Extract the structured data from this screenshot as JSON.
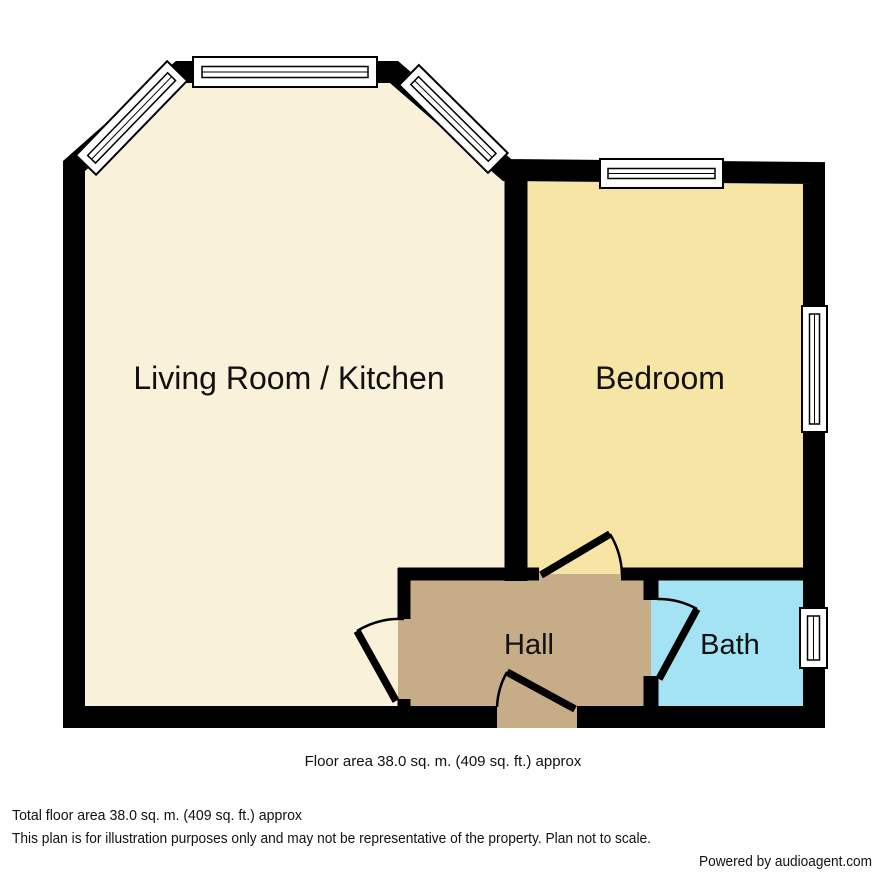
{
  "plan": {
    "wall_color": "#000000",
    "rooms": [
      {
        "name": "Living Room / Kitchen",
        "color": "#F9F1DA"
      },
      {
        "name": "Bedroom",
        "color": "#F7E5A6"
      },
      {
        "name": "Hall",
        "color": "#C7AC88"
      },
      {
        "name": "Bath",
        "color": "#A3E3F3"
      }
    ],
    "area_note": "Floor area 38.0 sq. m. (409 sq. ft.) approx"
  },
  "footer": {
    "total_area": "Total floor area 38.0 sq. m. (409 sq. ft.) approx",
    "disclaimer": "This plan is for illustration purposes only and may not be representative of the property. Plan not to scale.",
    "credit": "Powered by audioagent.com"
  }
}
